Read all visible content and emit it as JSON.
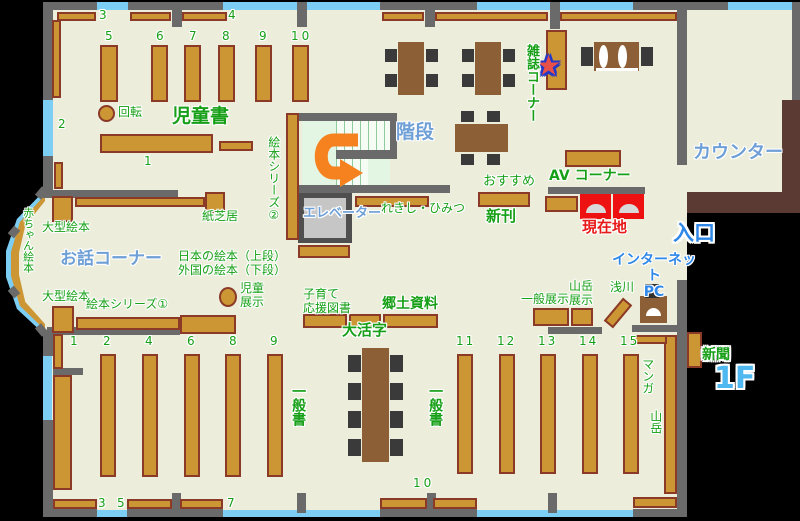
{
  "floor": "1F",
  "sections": {
    "jidosho": "児童書",
    "kaiten": "回転",
    "kamishibai": "紙芝居",
    "ogata_ehon": "大型絵本",
    "akachan_ehon": "赤ちゃん絵本",
    "ohanashi_corner": "お話コーナー",
    "ehon_series_1": "絵本シリーズ①",
    "ehon_series_2": "絵本シリーズ②",
    "nihon_ehon": "日本の絵本（上段）",
    "gaikoku_ehon": "外国の絵本（下段）",
    "jido_tenji": "児童\n展示",
    "kaidan": "階段",
    "elevator": "エレベーター",
    "rekishi_himitsu": "れきし・ひみつ",
    "zasshi_corner": "雑誌コーナー",
    "osusume": "おすすめ",
    "shinkan": "新刊",
    "av_corner": "AV コーナー",
    "genzaichi": "現在地",
    "counter": "カウンター",
    "iriguchi": "入口",
    "internet_pc": "インターネット\nPC",
    "asakawa": "浅川",
    "ippan_tenji": "一般展示",
    "sangaku_tenji": "山岳\n展示",
    "kosodate": "子育て\n応援図書",
    "kyodo_shiryo": "郷土資料",
    "daikatsuji": "大活字",
    "ippansho": "一般書",
    "manga": "マンガ",
    "sangaku": "山岳",
    "shinbun": "新聞",
    "star": "★"
  },
  "shelf_numbers": {
    "t3": "3",
    "t4": "4",
    "c1": "1",
    "c2": "2",
    "c5": "5",
    "c6": "6",
    "c7": "7",
    "c8": "8",
    "c9": "9",
    "c10": "10",
    "b1": "1",
    "b2": "2",
    "b3": "3",
    "b4": "4",
    "b5": "5",
    "b6": "6",
    "b7": "7",
    "b8": "8",
    "b9": "9",
    "b10": "10",
    "b11": "11",
    "b12": "12",
    "b13": "13",
    "b14": "14",
    "b15": "15"
  },
  "colors": {
    "floor": "#ECEDDB",
    "wall": "#6A6A6A",
    "window": "#7CCEF4",
    "shelf": "#CC9634",
    "shelf_border": "#8B3A28",
    "table": "#8D5F36",
    "counter": "#5A3A32",
    "gate_red": "#EE1111",
    "arrow_orange": "#F5821F",
    "label_green": "#17A017",
    "label_blue": "#6E9FD6",
    "label_blue_bright": "#2F87E8",
    "floor_label_blue": "#4FB8F0",
    "current_location_red": "#E81919",
    "star_red": "#E8504A",
    "star_outline_blue": "#2438C8"
  }
}
